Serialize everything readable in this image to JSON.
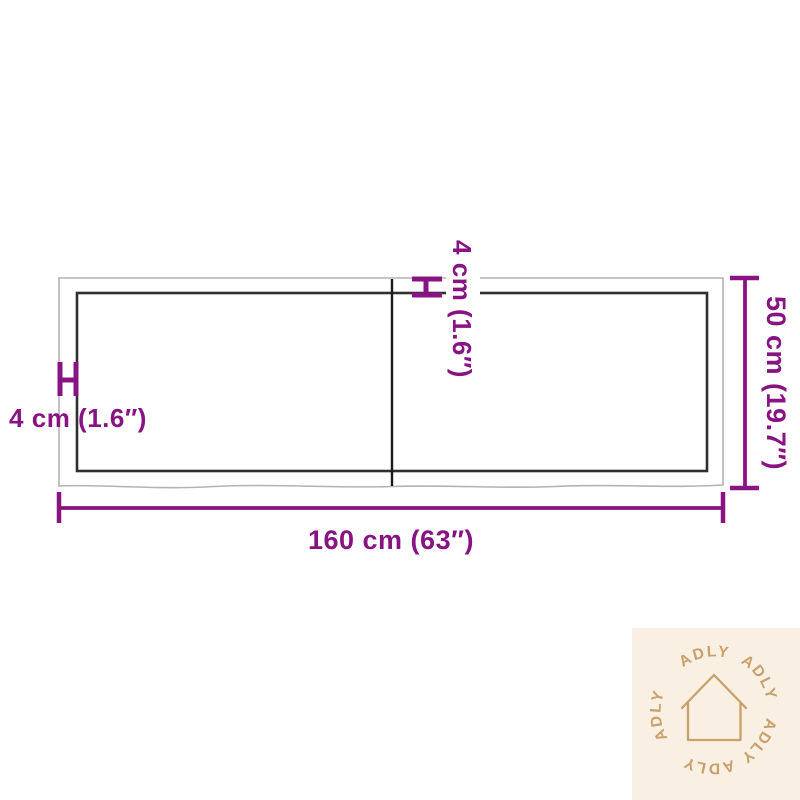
{
  "diagram": {
    "product": "table-top-dimension-diagram",
    "labels": {
      "width": "160 cm (63″)",
      "height": "50 cm (19.7″)",
      "thickness_top": "4 cm (1.6″)",
      "thickness_left": "4 cm (1.6″)"
    },
    "colors": {
      "dimension_accent": "#871482",
      "board_outer_edge": "#b3b3b3",
      "board_inner_edge": "#303030",
      "board_divider": "#1b1b1b"
    }
  },
  "watermark": {
    "brand": "ADLY",
    "icon": "house-outline-icon",
    "colors": {
      "background": "#f9efe2",
      "foreground": "#c7a06a"
    }
  }
}
